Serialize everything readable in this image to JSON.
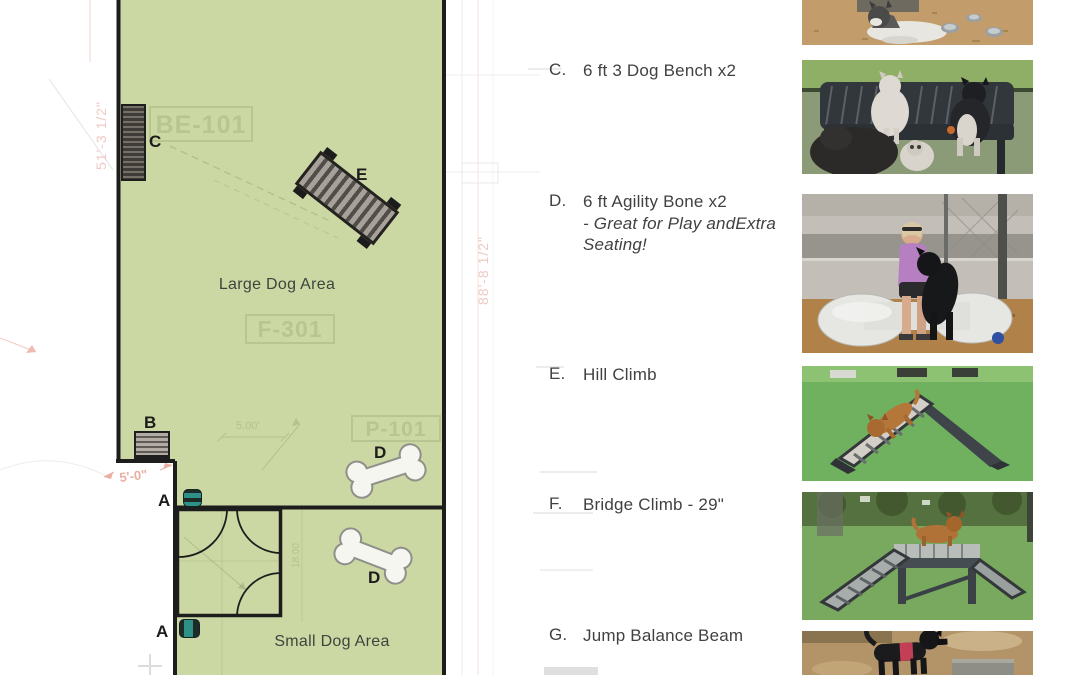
{
  "plan": {
    "area_labels": {
      "large": "Large Dog Area",
      "small": "Small Dog Area"
    },
    "markers": {
      "a": "A",
      "b": "B",
      "c": "C",
      "d": "D",
      "e": "E"
    },
    "ref_labels": {
      "be": "BE-101",
      "f": "F-301",
      "p": "P-101"
    },
    "dimensions": {
      "left_vertical": "51'-3 1/2\"",
      "right_vertical": "88'-8 1/2\"",
      "gate": "5'-0\"",
      "dim_5": "5.00'",
      "dim_18": "18.00"
    },
    "colors": {
      "turf": "#ccd8a4",
      "outline": "#1d1d1d",
      "faded_label": "#b2c18c",
      "dim_pink": "#eecac5",
      "dim_green": "#b3c28c",
      "teal": "#2e9187"
    }
  },
  "legend": {
    "items": [
      {
        "letter": "C.",
        "label": "6 ft 3 Dog Bench x2",
        "note1": "",
        "note2": ""
      },
      {
        "letter": "D.",
        "label": "6 ft Agility Bone x2",
        "note1": "- Great for Play andExtra",
        "note2": "Seating!"
      },
      {
        "letter": "E.",
        "label": "Hill Climb",
        "note1": "",
        "note2": ""
      },
      {
        "letter": "F.",
        "label": "Bridge Climb - 29\"",
        "note1": "",
        "note2": ""
      },
      {
        "letter": "G.",
        "label": "Jump Balance Beam",
        "note1": "",
        "note2": ""
      }
    ]
  },
  "photos": {
    "top": "husky-dog-water-bowls-photo",
    "c": "dogs-on-bench-photo",
    "d": "woman-dog-bone-bench-photo",
    "e": "dog-hill-climb-photo",
    "f": "dog-bridge-climb-photo",
    "g": "dog-balance-beam-photo"
  }
}
